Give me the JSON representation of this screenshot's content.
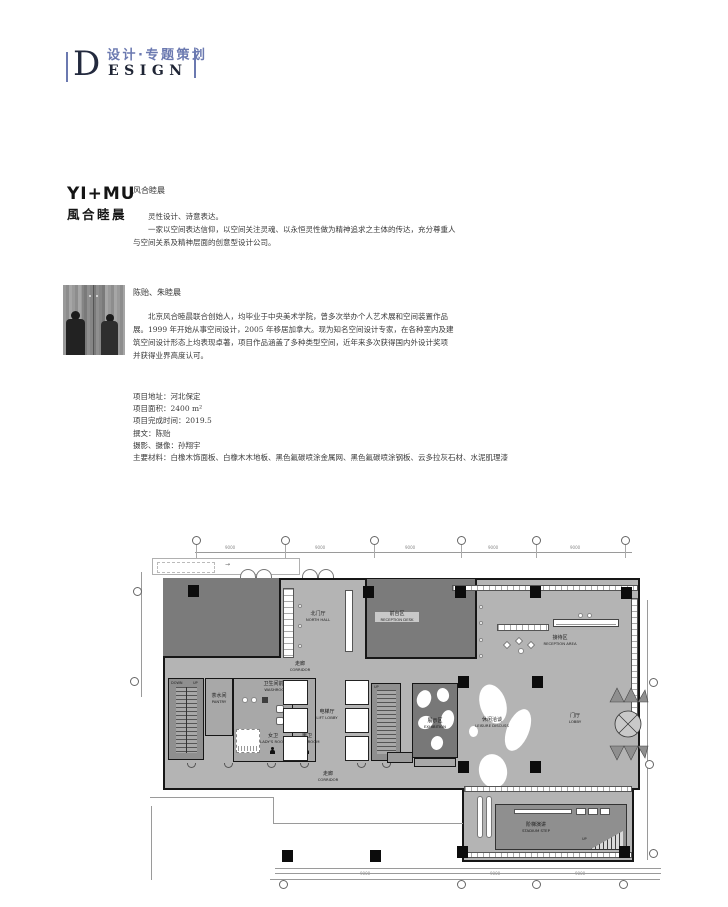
{
  "accent_color": "#6b79b0",
  "header": {
    "title_cn": "设计·专题策划",
    "initial": "D",
    "title_en_rest": "ESIGN"
  },
  "studio": {
    "logo_line1": "YI+MU",
    "logo_line2": "風合睦晨",
    "section_title": "风合睦晨",
    "intro_para1": "灵性设计、诗意表达。",
    "intro_para2": "一家以空间表达信仰，以空间关注灵魂、以永恒灵性做为精神追求之主体的传达，充分尊重人与空间关系及精神层面的创意型设计公司。"
  },
  "designers": {
    "section_title": "陈贻、朱睦晨",
    "bio": "北京风合睦晨联合创始人，均毕业于中央美术学院，曾多次举办个人艺术展和空间装置作品展。1999 年开始从事空间设计，2005 年移居加拿大。现为知名空间设计专家，在各种室内及建筑空间设计形态上均表现卓著，项目作品涵盖了多种类型空间，近年来多次获得国内外设计奖项并获得业界高度认可。"
  },
  "project": {
    "lines": [
      "项目地址：河北保定",
      "项目面积：2400 m²",
      "项目完成时间：2019.5",
      "撰文：陈贻",
      "摄影、摄像：孙翔宇",
      "主要材料：白橡木饰面板、白橡木木地板、黑色氟碳喷涂金属网、黑色氟碳喷涂钢板、云多拉灰石材、水泥肌理漆"
    ]
  },
  "plan": {
    "dim_label": "9000",
    "colors": {
      "dark_room": "#7b7b7b",
      "floor": "#b4b4b4",
      "wall": "#161616"
    },
    "labels": {
      "north_hall": {
        "cn": "北门厅",
        "en": "NORTH HALL"
      },
      "reception_desk": {
        "cn": "前台区",
        "en": "RECEPTION DESK"
      },
      "reception_area": {
        "cn": "接待区",
        "en": "RECEPTION AREA"
      },
      "corridor": {
        "cn": "走廊",
        "en": "CORRIDOR"
      },
      "washroom": {
        "cn": "卫生间前室",
        "en": "WASHROOM"
      },
      "ladies": {
        "cn": "女卫",
        "en": "LADY'S ROOM"
      },
      "mens": {
        "cn": "男卫",
        "en": "MEN'S ROOM"
      },
      "lift_lobby": {
        "cn": "电梯厅",
        "en": "LIFT LOBBY"
      },
      "pantry": {
        "cn": "茶水间",
        "en": "PANTRY"
      },
      "exhibition": {
        "cn": "展示区",
        "en": "EXHIBITION"
      },
      "leisure": {
        "cn": "休闲洽谈",
        "en": "LEISURE DISCUSS"
      },
      "lobby": {
        "cn": "门厅",
        "en": "LOBBY"
      },
      "stadium": {
        "cn": "阶梯演讲",
        "en": "STADIUM STEP"
      },
      "down": "DOWN",
      "up": "UP"
    }
  }
}
